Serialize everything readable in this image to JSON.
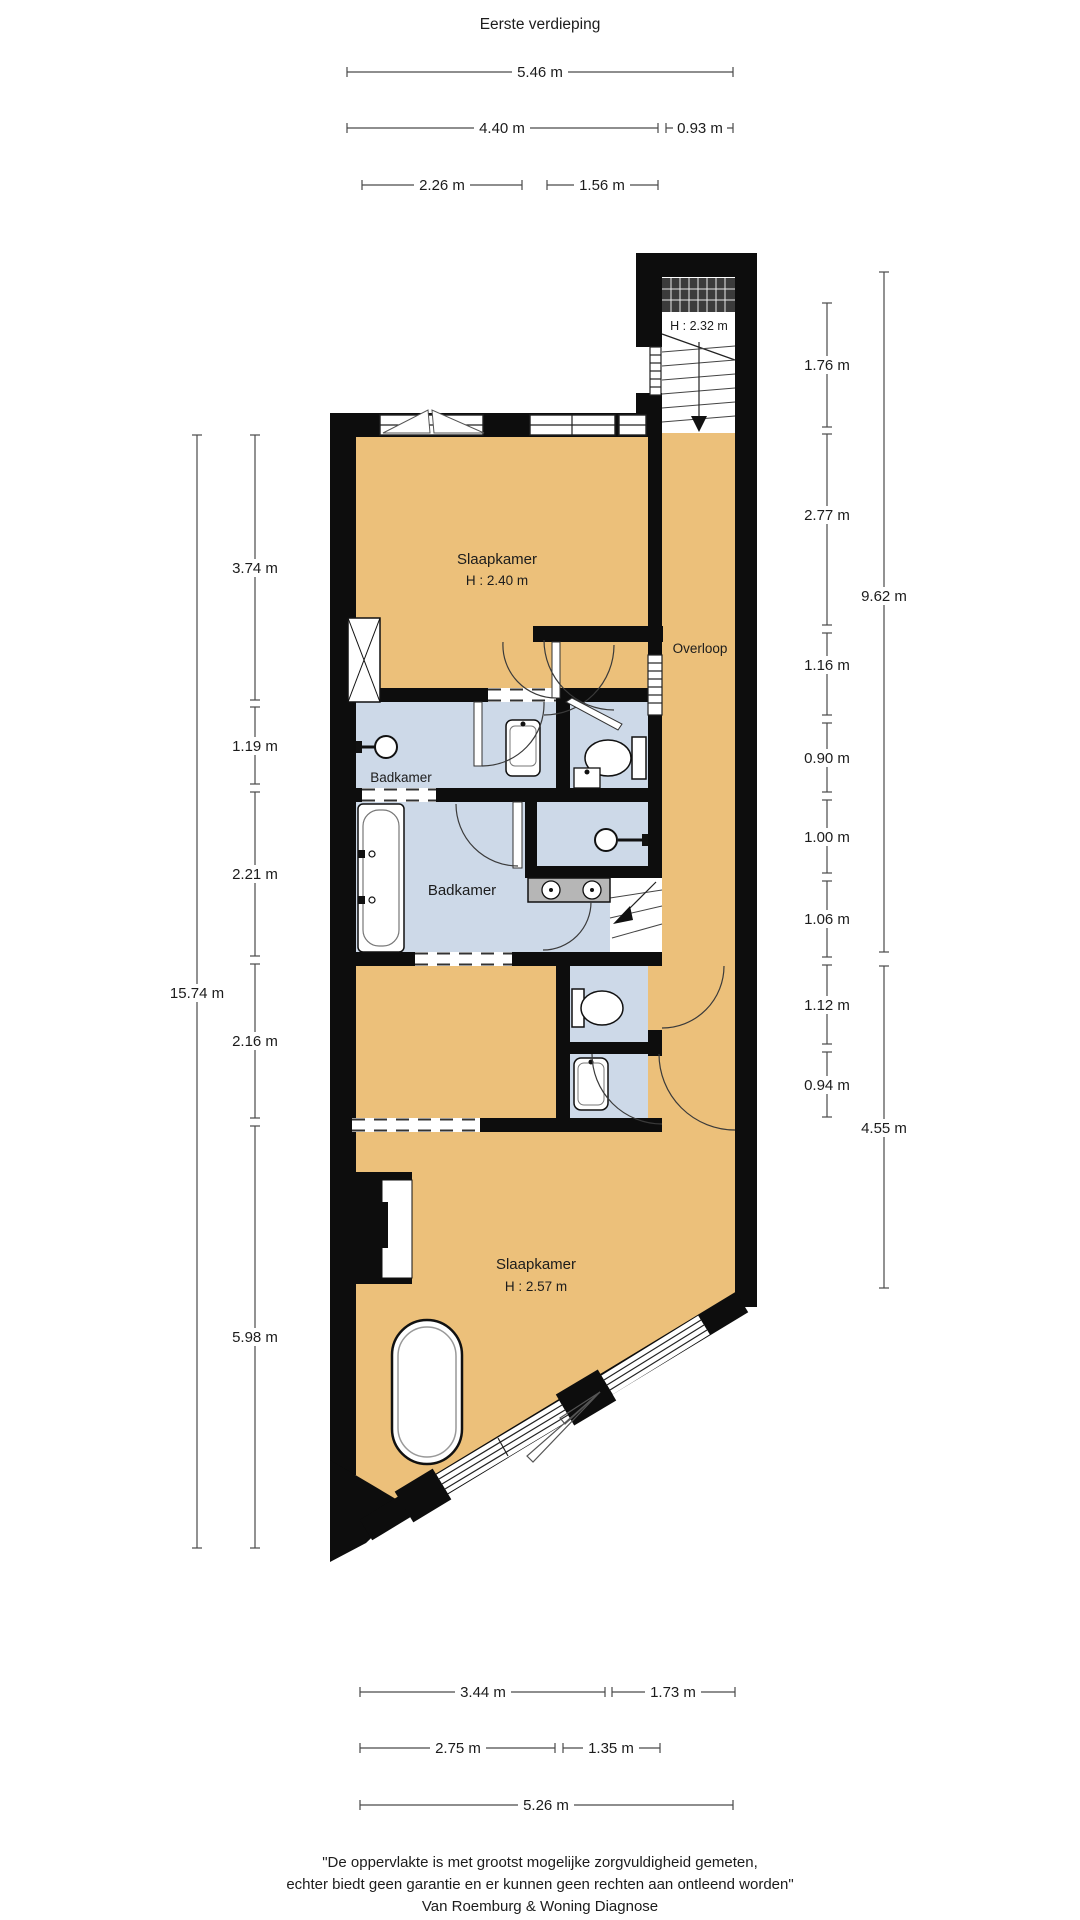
{
  "title": "Eerste verdieping",
  "plan": {
    "rooms": {
      "stairwell": {
        "height": "H : 2.32 m"
      },
      "bedroom_top": {
        "label": "Slaapkamer",
        "height": "H : 2.40 m"
      },
      "landing": {
        "label": "Overloop"
      },
      "bathroom_small": {
        "label": "Badkamer"
      },
      "bathroom_large": {
        "label": "Badkamer"
      },
      "bedroom_bottom": {
        "label": "Slaapkamer",
        "height": "H : 2.57 m"
      }
    },
    "colors": {
      "room_fill": "#ecc07a",
      "wet_room_fill": "#cdd9e8",
      "wall": "#0d0d0d",
      "vanity": "#b6b6b6"
    }
  },
  "dimensions": {
    "top": [
      "5.46 m",
      "4.40 m",
      "0.93 m",
      "2.26 m",
      "1.56 m"
    ],
    "left": [
      "3.74 m",
      "1.19 m",
      "2.21 m",
      "2.16 m",
      "5.98 m"
    ],
    "left_total": "15.74 m",
    "right": [
      "1.76 m",
      "2.77 m",
      "1.16 m",
      "0.90 m",
      "1.00 m",
      "1.06 m",
      "1.12 m",
      "0.94 m"
    ],
    "right_total": "9.62 m",
    "right_lower_total": "4.55 m",
    "bottom": [
      "3.44 m",
      "1.73 m",
      "2.75 m",
      "1.35 m",
      "5.26 m"
    ]
  },
  "footer": {
    "line1": "\"De oppervlakte is met grootst mogelijke zorgvuldigheid gemeten,",
    "line2": "echter biedt geen garantie en er kunnen geen rechten aan ontleend worden\"",
    "line3": "Van Roemburg & Woning Diagnose"
  }
}
